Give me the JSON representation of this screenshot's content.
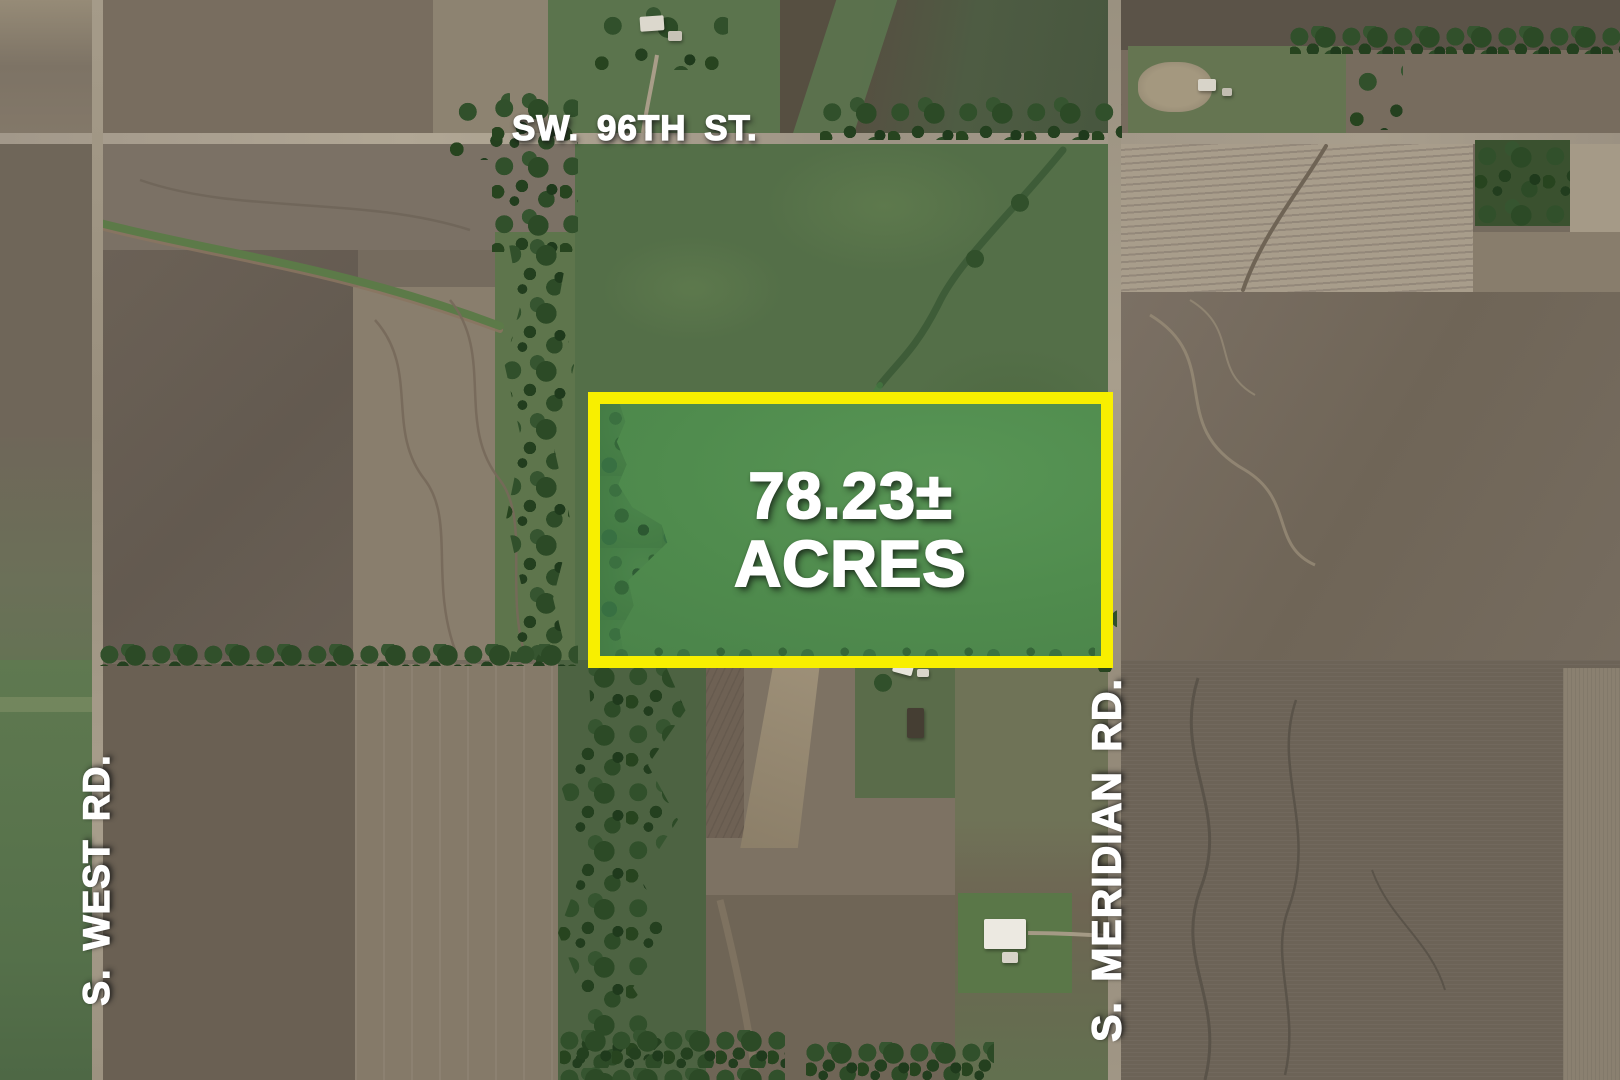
{
  "map": {
    "description": "Aerial farmland map with highlighted sale parcel",
    "road_labels": {
      "top": "SW. 96TH ST.",
      "left": "S. WEST RD.",
      "right": "S. MERIDIAN RD."
    },
    "parcel": {
      "acreage": "78.23±",
      "unit": "ACRES",
      "highlight_border_color": "#F8EF00",
      "highlight_fill_color": "#4F8B4D",
      "label_color": "#FFFFFF"
    }
  }
}
